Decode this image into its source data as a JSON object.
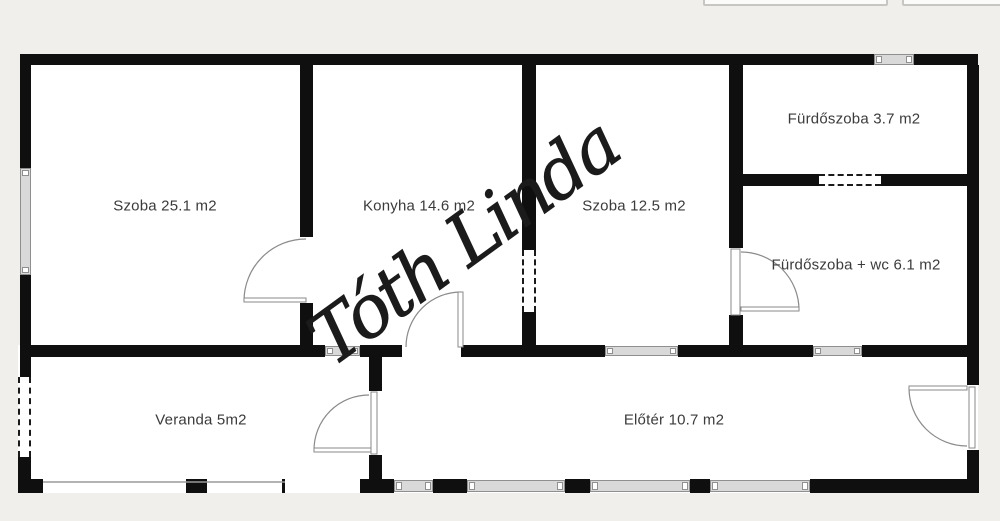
{
  "plan_title": "Floor plan",
  "watermark": {
    "text": "Tóth Linda"
  },
  "rooms": [
    {
      "id": "szoba-nagy",
      "label": "Szoba 25.1 m2"
    },
    {
      "id": "konyha",
      "label": "Konyha 14.6 m2"
    },
    {
      "id": "szoba-kis",
      "label": "Szoba 12.5 m2"
    },
    {
      "id": "furdoszoba",
      "label": "Fürdőszoba 3.7 m2"
    },
    {
      "id": "furdoszoba-wc",
      "label": "Fürdőszoba + wc 6.1 m2"
    },
    {
      "id": "veranda",
      "label": "Veranda 5m2"
    },
    {
      "id": "eloter",
      "label": "Előtér 10.7 m2"
    }
  ],
  "theme": {
    "bg": "#f0efeb",
    "room": "#ffffff",
    "wall": "#0f0f0f",
    "window-fill": "#d9d9d9",
    "window-border": "#8f8f8f",
    "door-line": "#8a8a8a",
    "label": "#3b3b3b",
    "signature": "#1b1b1b"
  }
}
